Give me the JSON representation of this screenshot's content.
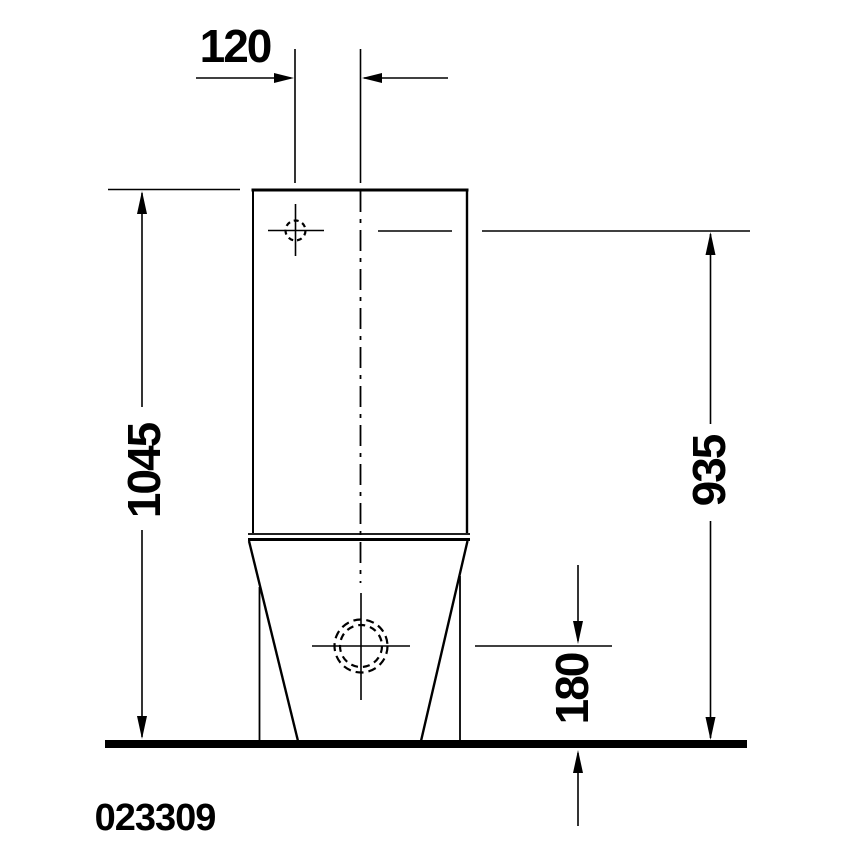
{
  "colors": {
    "background": "#ffffff",
    "line": "#000000"
  },
  "drawing": {
    "product_code": "023309",
    "dimensions": {
      "top_offset": "120",
      "overall_height": "1045",
      "right_height": "935",
      "outlet_height": "180"
    }
  }
}
